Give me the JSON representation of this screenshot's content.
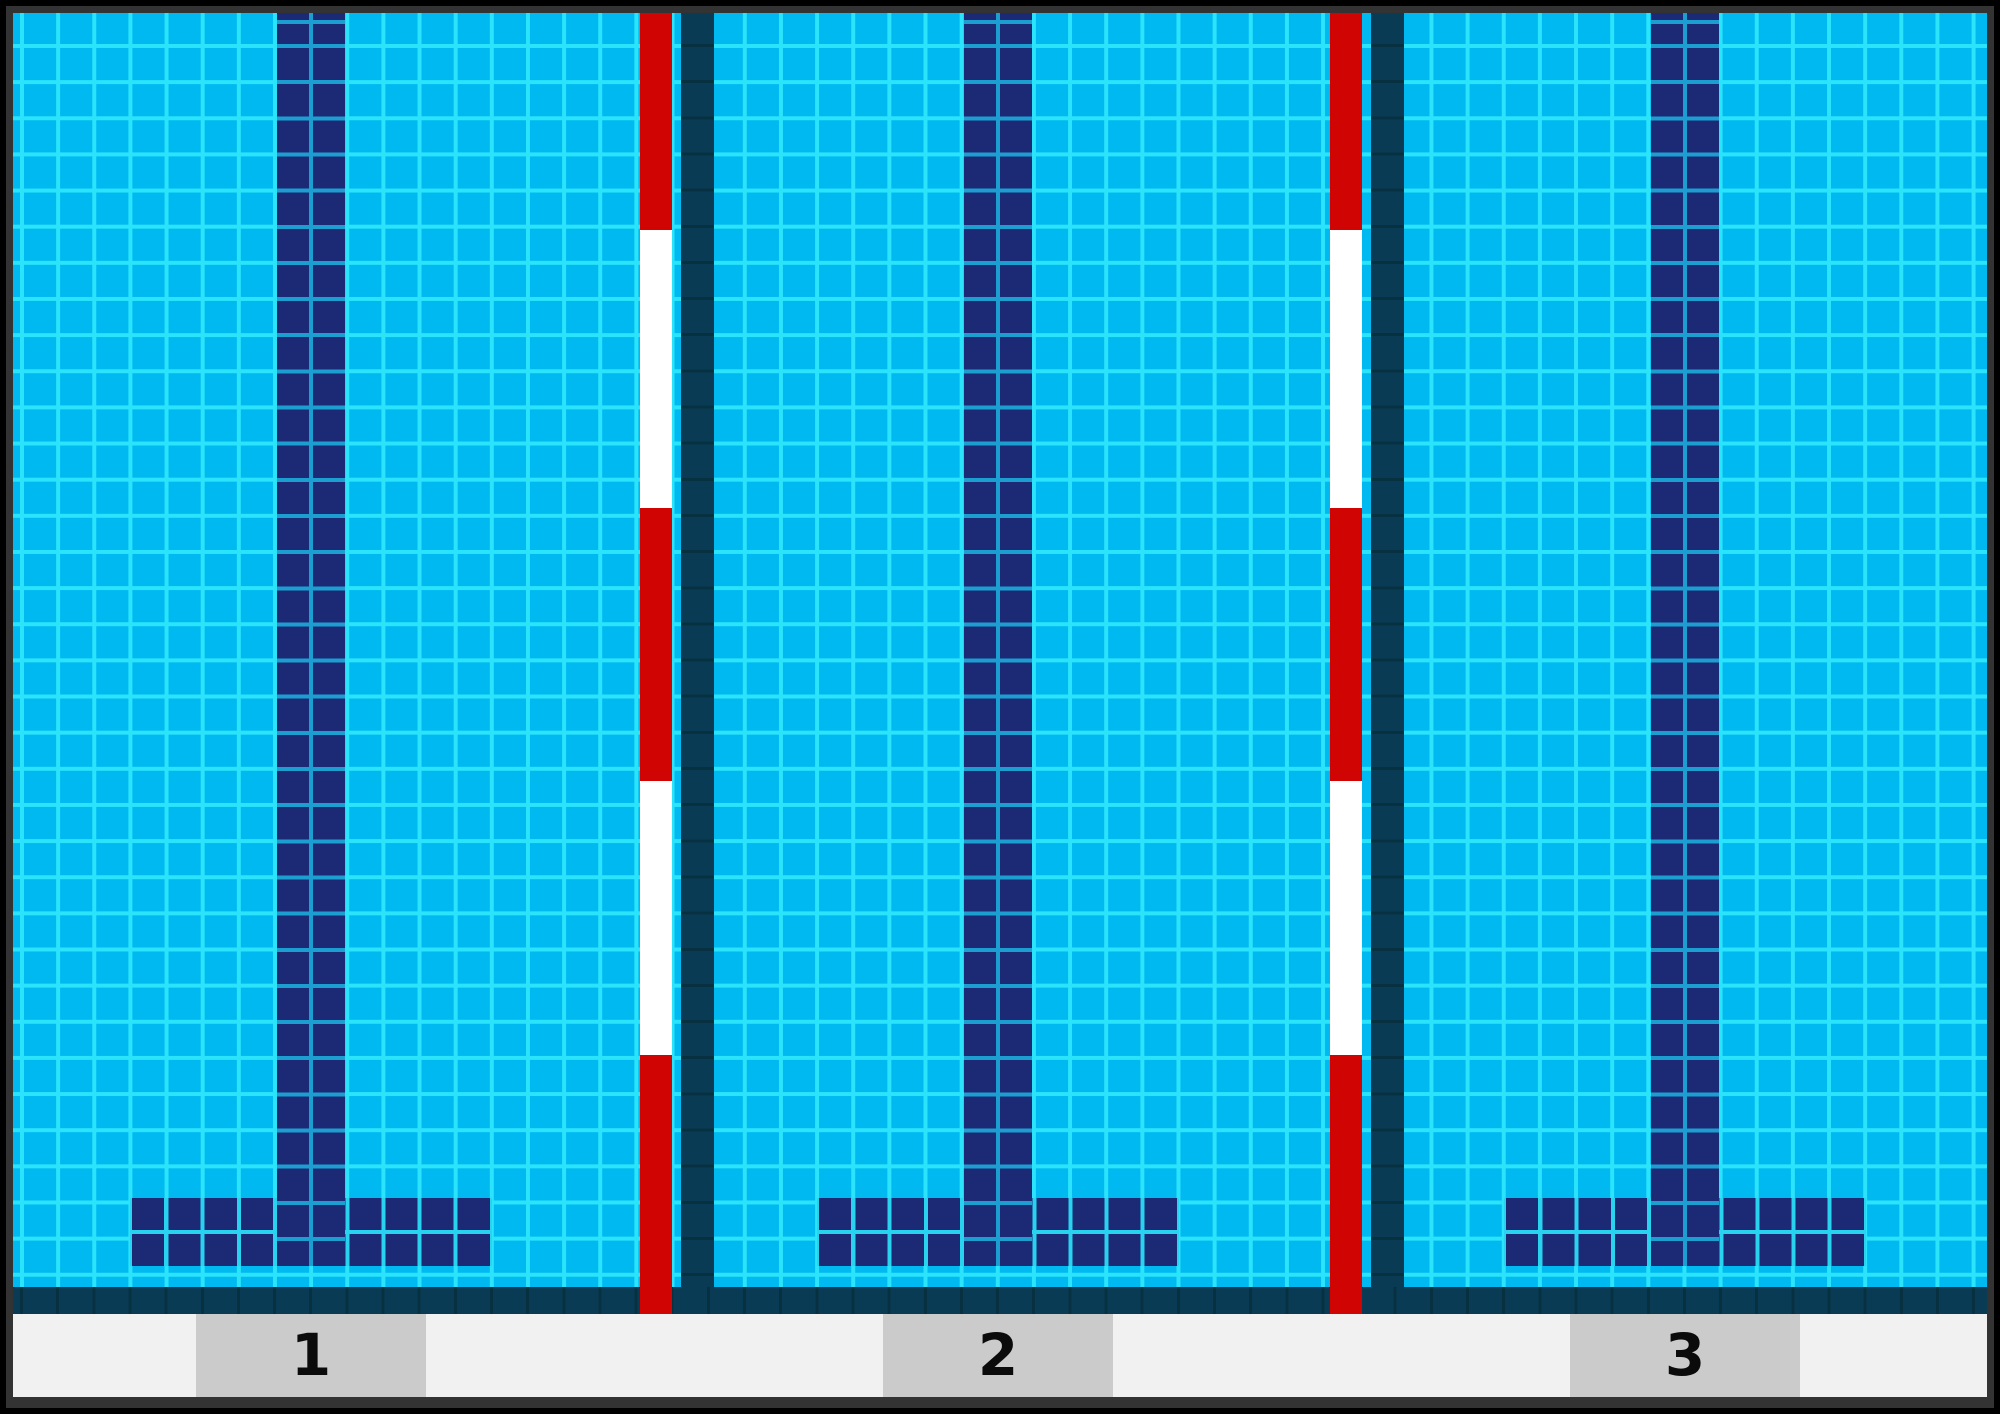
{
  "scene": {
    "description": "Top-down tiled illustration of a swimming pool with three numbered lanes",
    "pool": {
      "lanes": [
        {
          "label": "1"
        },
        {
          "label": "2"
        },
        {
          "label": "3"
        }
      ],
      "rope_pattern": {
        "segments": [
          {
            "color": "red",
            "height_px": 217
          },
          {
            "color": "white",
            "height_px": 278
          },
          {
            "color": "red",
            "height_px": 273
          },
          {
            "color": "white",
            "height_px": 274
          },
          {
            "color": "red",
            "height_px": 259
          }
        ]
      },
      "colors": {
        "water": "#00b9f1",
        "tile_grout": "#2be4fb",
        "lane_marking_navy": "#1c2a76",
        "lane_rope_red": "#d10404",
        "lane_rope_white": "#ffffff",
        "divider_wall_teal": "#0a3b54",
        "deck": "#f1f1f1",
        "number_plate": "#cbcbcb",
        "number_text": "#0b0b0b",
        "frame": "#000000"
      }
    }
  }
}
